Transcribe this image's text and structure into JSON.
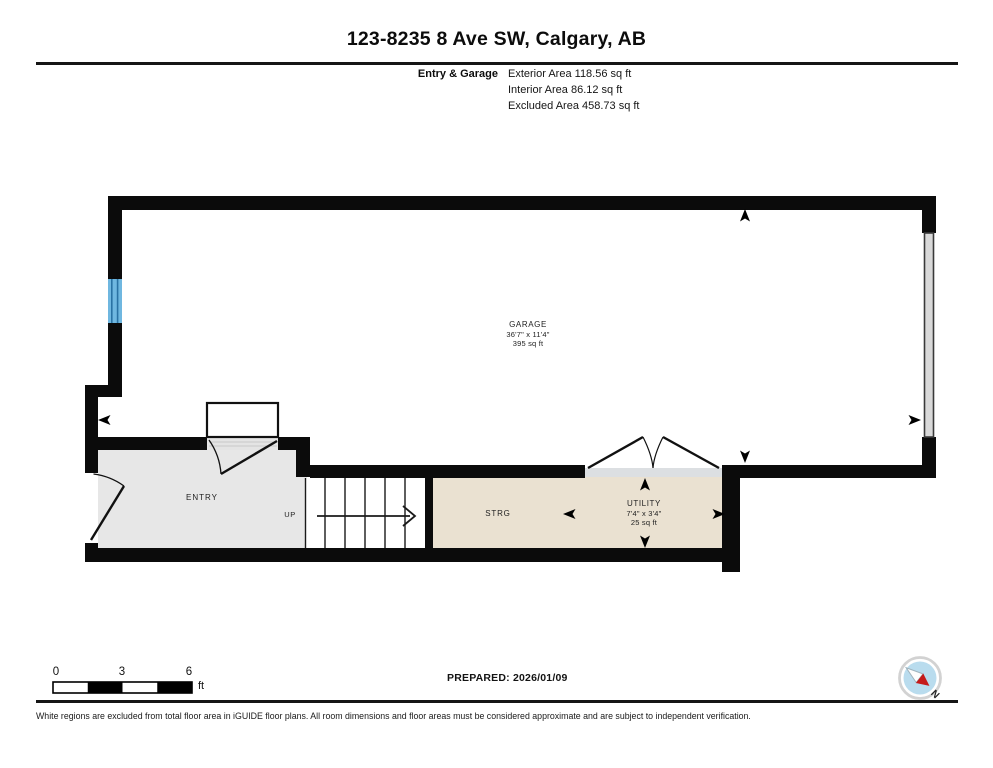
{
  "header": {
    "title": "123-8235 8 Ave SW, Calgary, AB",
    "floor_name": "Entry & Garage",
    "area_lines": [
      "Exterior Area 118.56 sq ft",
      "Interior Area 86.12 sq ft",
      "Excluded Area 458.73 sq ft"
    ]
  },
  "plan": {
    "rooms": {
      "garage": {
        "name": "GARAGE",
        "dimensions": "36'7\" x 11'4\"",
        "area": "395 sq ft"
      },
      "entry": {
        "name": "ENTRY"
      },
      "stairs": {
        "label": "UP"
      },
      "storage": {
        "name": "STRG"
      },
      "utility": {
        "name": "UTILITY",
        "dimensions": "7'4\" x 3'4\"",
        "area": "25 sq ft"
      }
    }
  },
  "scale_bar": {
    "tick_0": "0",
    "tick_3": "3",
    "tick_6": "6",
    "unit": "ft"
  },
  "compass": {
    "north_label": "N"
  },
  "footer": {
    "prepared": "PREPARED: 2026/01/09",
    "disclaimer": "White regions are excluded from total floor area in iGUIDE floor plans. All room dimensions and floor areas must be considered approximate and are subject to independent verification."
  },
  "colors": {
    "wall": "#0b0b0b",
    "interior_room_fill": "#e7e7e7",
    "excluded_room_fill": "#eae1d1",
    "threshold_fill": "#dcdfe2",
    "window_fill": "#6fb7e0",
    "window_line": "#2a72a4",
    "garage_overhead_door_fill": "#d9d9d9",
    "compass_ring": "#d2d2d2",
    "compass_face": "#b9dcee",
    "compass_needle_red": "#c51a1a"
  }
}
